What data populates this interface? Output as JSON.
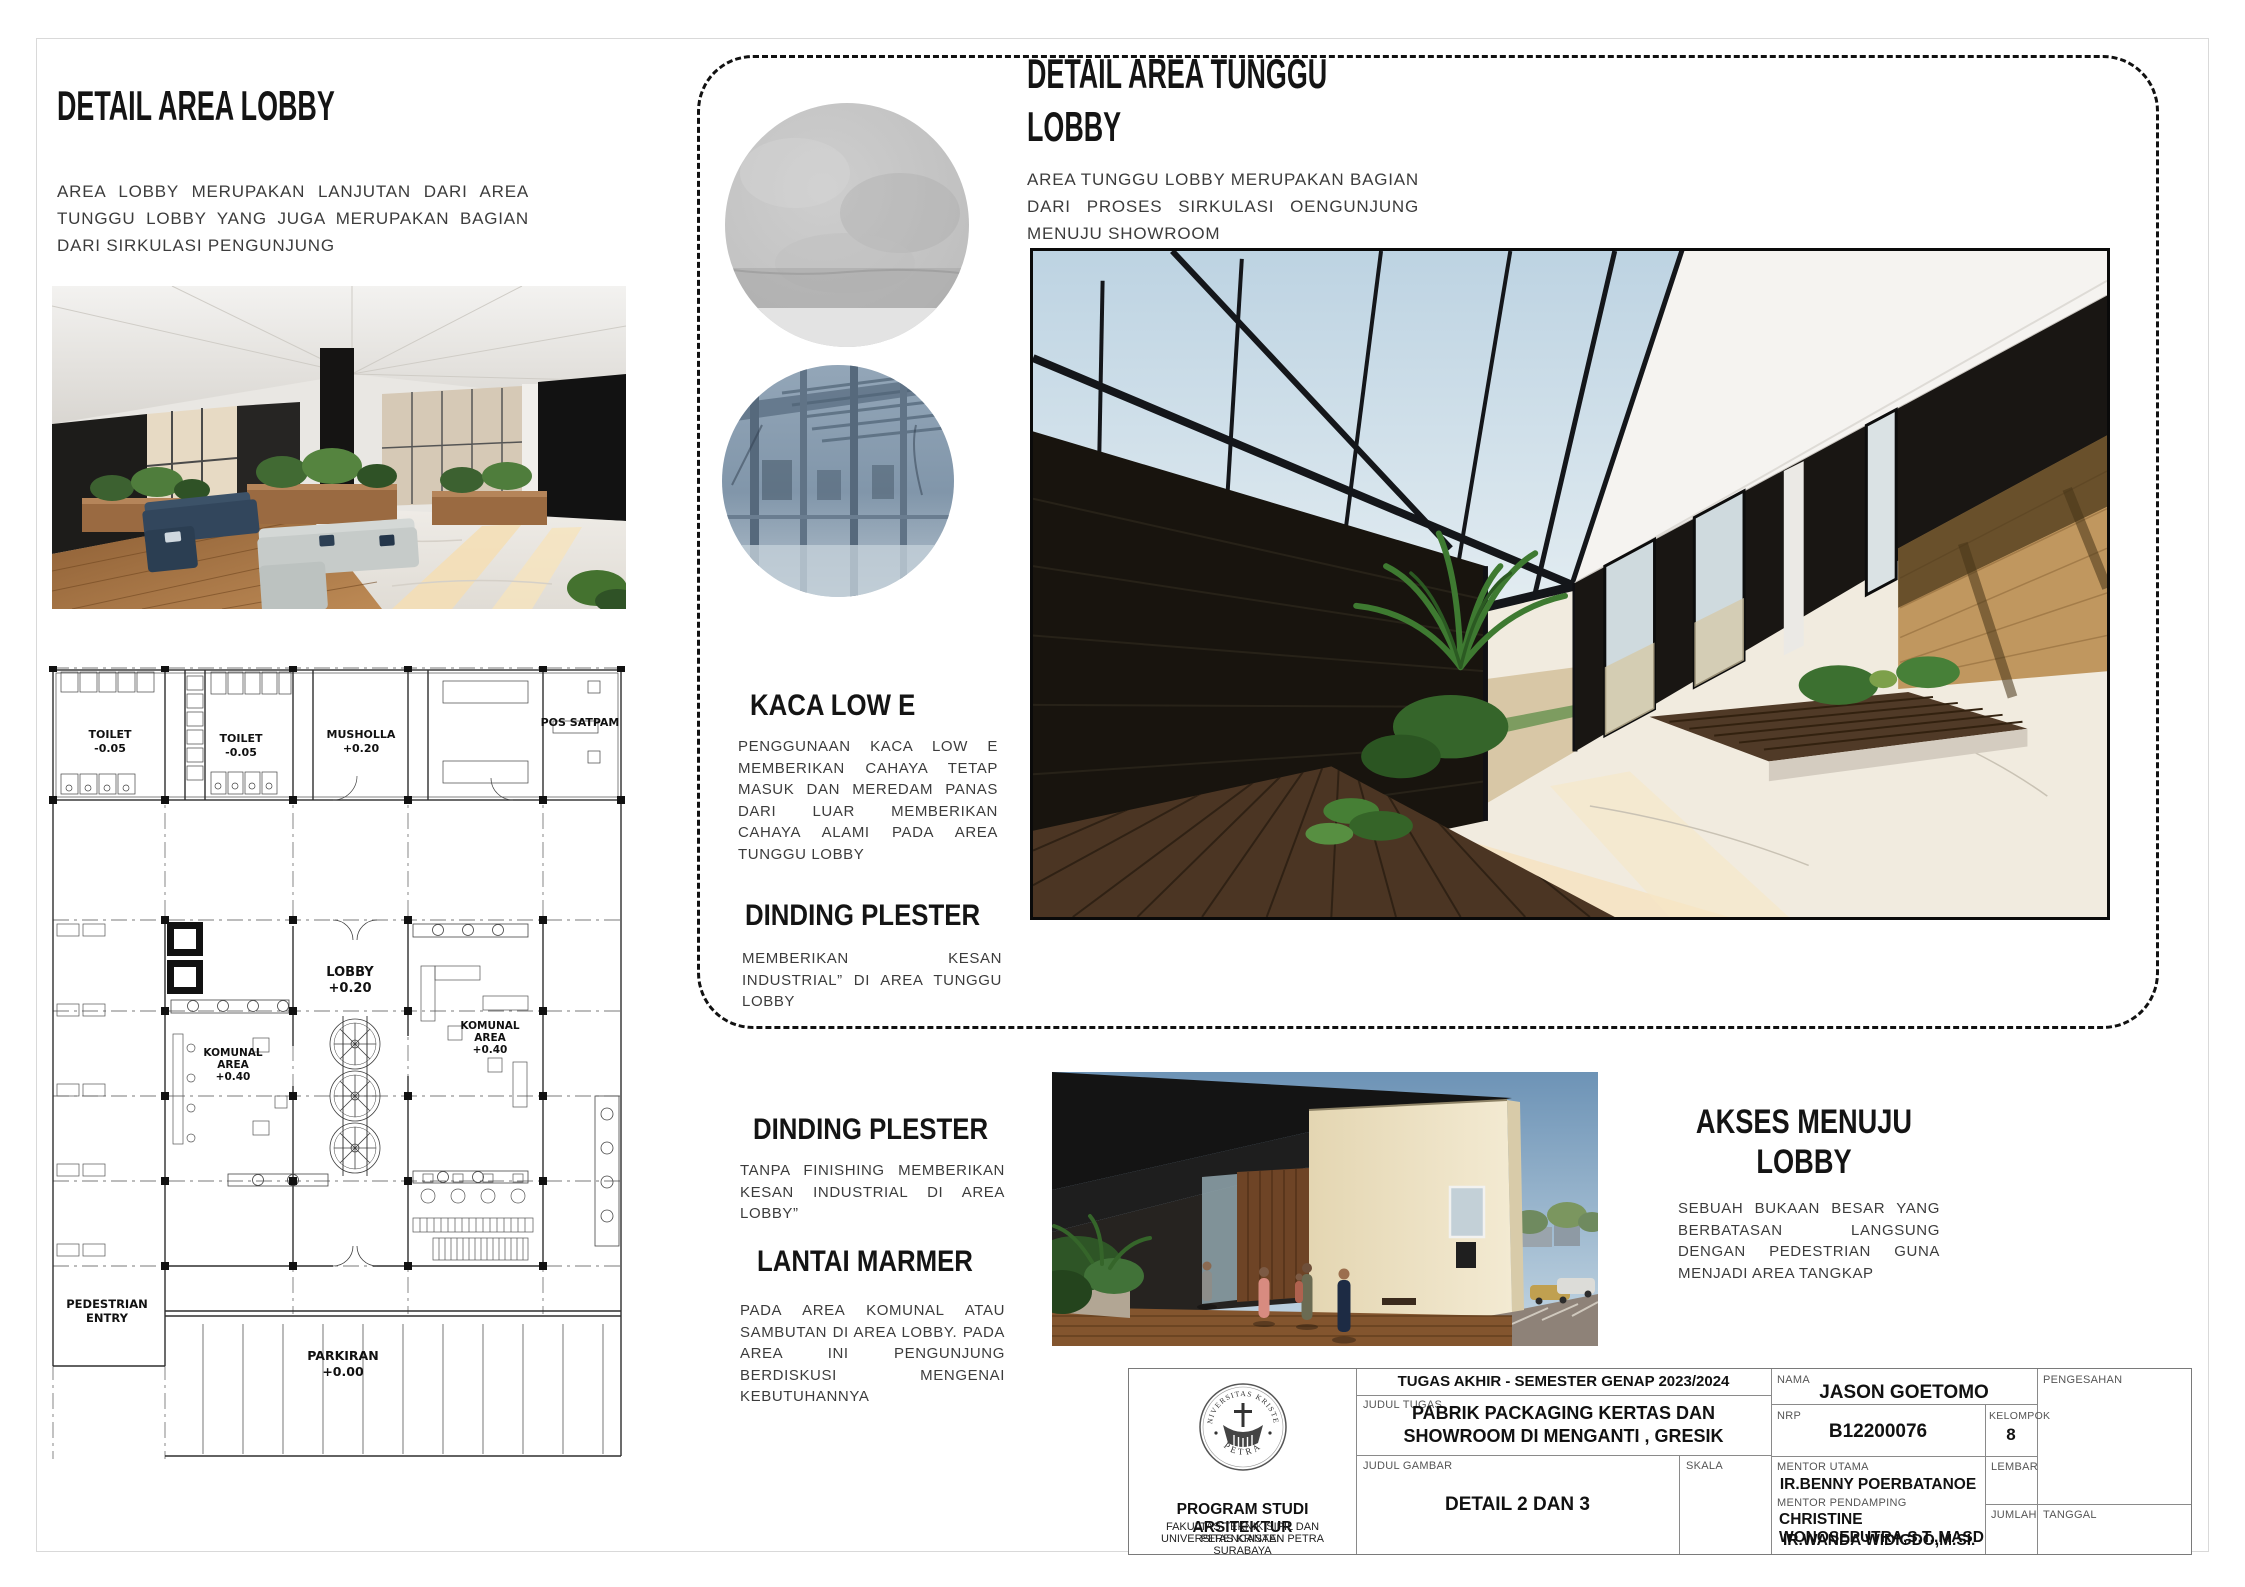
{
  "sections": {
    "lobby": {
      "title": "DETAIL AREA LOBBY",
      "body": "AREA LOBBY MERUPAKAN LANJUTAN DARI AREA TUNGGU LOBBY YANG JUGA MERUPAKAN BAGIAN DARI SIRKULASI PENGUNJUNG"
    },
    "tunggu": {
      "title_line1": "DETAIL AREA TUNGGU",
      "title_line2": "LOBBY",
      "body": "AREA TUNGGU LOBBY MERUPAKAN BAGIAN DARI PROSES SIRKULASI OENGUNJUNG MENUJU SHOWROOM"
    },
    "kaca": {
      "title": "KACA LOW E",
      "body": "PENGGUNAAN KACA LOW E MEMBERIKAN CAHAYA TETAP MASUK DAN MEREDAM PANAS DARI LUAR MEMBERIKAN CAHAYA ALAMI PADA AREA TUNGGU LOBBY"
    },
    "dinding_tunggu": {
      "title": "DINDING PLESTER",
      "body": "MEMBERIKAN KESAN INDUSTRIAL” DI AREA TUNGGU LOBBY"
    },
    "dinding_lobby": {
      "title": "DINDING PLESTER",
      "body": "TANPA FINISHING MEMBERIKAN KESAN INDUSTRIAL DI AREA LOBBY”"
    },
    "lantai": {
      "title": "LANTAI MARMER",
      "body": "PADA AREA KOMUNAL ATAU SAMBUTAN DI AREA LOBBY. PADA AREA INI PENGUNJUNG BERDISKUSI MENGENAI KEBUTUHANNYA"
    },
    "akses": {
      "title_line1": "AKSES MENUJU",
      "title_line2": "LOBBY",
      "body": "SEBUAH BUKAAN BESAR YANG BERBATASAN LANGSUNG DENGAN PEDESTRIAN GUNA MENJADI AREA TANGKAP"
    }
  },
  "plan": {
    "rooms": [
      {
        "lines": [
          "TOILET",
          "-0.05"
        ]
      },
      {
        "lines": [
          "TOILET",
          "-0.05"
        ]
      },
      {
        "lines": [
          "MUSHOLLA",
          "+0.20"
        ]
      },
      {
        "lines": [
          "POS SATPAM"
        ]
      },
      {
        "lines": [
          "LOBBY",
          "+0.20"
        ]
      },
      {
        "lines": [
          "KOMUNAL",
          "AREA",
          "+0.40"
        ]
      },
      {
        "lines": [
          "KOMUNAL",
          "AREA",
          "+0.40"
        ]
      },
      {
        "lines": [
          "PEDESTRIAN",
          "ENTRY"
        ]
      },
      {
        "lines": [
          "PARKIRAN",
          "+0.00"
        ]
      }
    ]
  },
  "title_block": {
    "institution": {
      "seal_top": "UNIVERSITAS KRISTEN",
      "seal_bottom": "PETRA",
      "program": "PROGRAM STUDI ARSITEKTUR",
      "faculty": "FAKULTAS TEKNIK SIPIL DAN PERENCANAAN",
      "university": "UNIVERSITAS KRISTEN PETRA",
      "city": "SURABAYA"
    },
    "header": "TUGAS AKHIR - SEMESTER GENAP 2023/2024",
    "judul_tugas_label": "JUDUL TUGAS",
    "judul_tugas": "PABRIK PACKAGING KERTAS DAN SHOWROOM DI MENGANTI , GRESIK",
    "judul_gambar_label": "JUDUL GAMBAR",
    "judul_gambar": "DETAIL 2 DAN 3",
    "skala_label": "SKALA",
    "nama_label": "NAMA",
    "nama": "JASON GOETOMO",
    "nrp_label": "NRP",
    "nrp": "B12200076",
    "kelompok_label": "KELOMPOK",
    "kelompok": "8",
    "mentor_utama_label": "MENTOR UTAMA",
    "mentor_utama": "IR.BENNY POERBATANOE",
    "mentor_pendamping_label": "MENTOR PENDAMPING",
    "mentor_pendamping_line1": "CHRISTINE WONOSEPUTRA,S.T.,MASD",
    "mentor_pendamping_line2": "IR.WANDA WIDIGDO,M.SI.",
    "lembar_label": "LEMBAR",
    "jumlah_label": "JUMLAH",
    "pengesahan_label": "PENGESAHAN",
    "tanggal_label": "TANGGAL"
  },
  "colors": {
    "heading": "#141414",
    "body_text": "#3c3c3c",
    "charred_wall": "#17140f",
    "rammed_earth": "#c0975f",
    "marble_floor": "#f1ebdf",
    "wood_deck": "#4b3523",
    "glass_blue": "#8aa0b4",
    "plaster_gray": "#c3c3c3",
    "cream_wall": "#ebdfc2",
    "sky": "#86a8c6"
  }
}
